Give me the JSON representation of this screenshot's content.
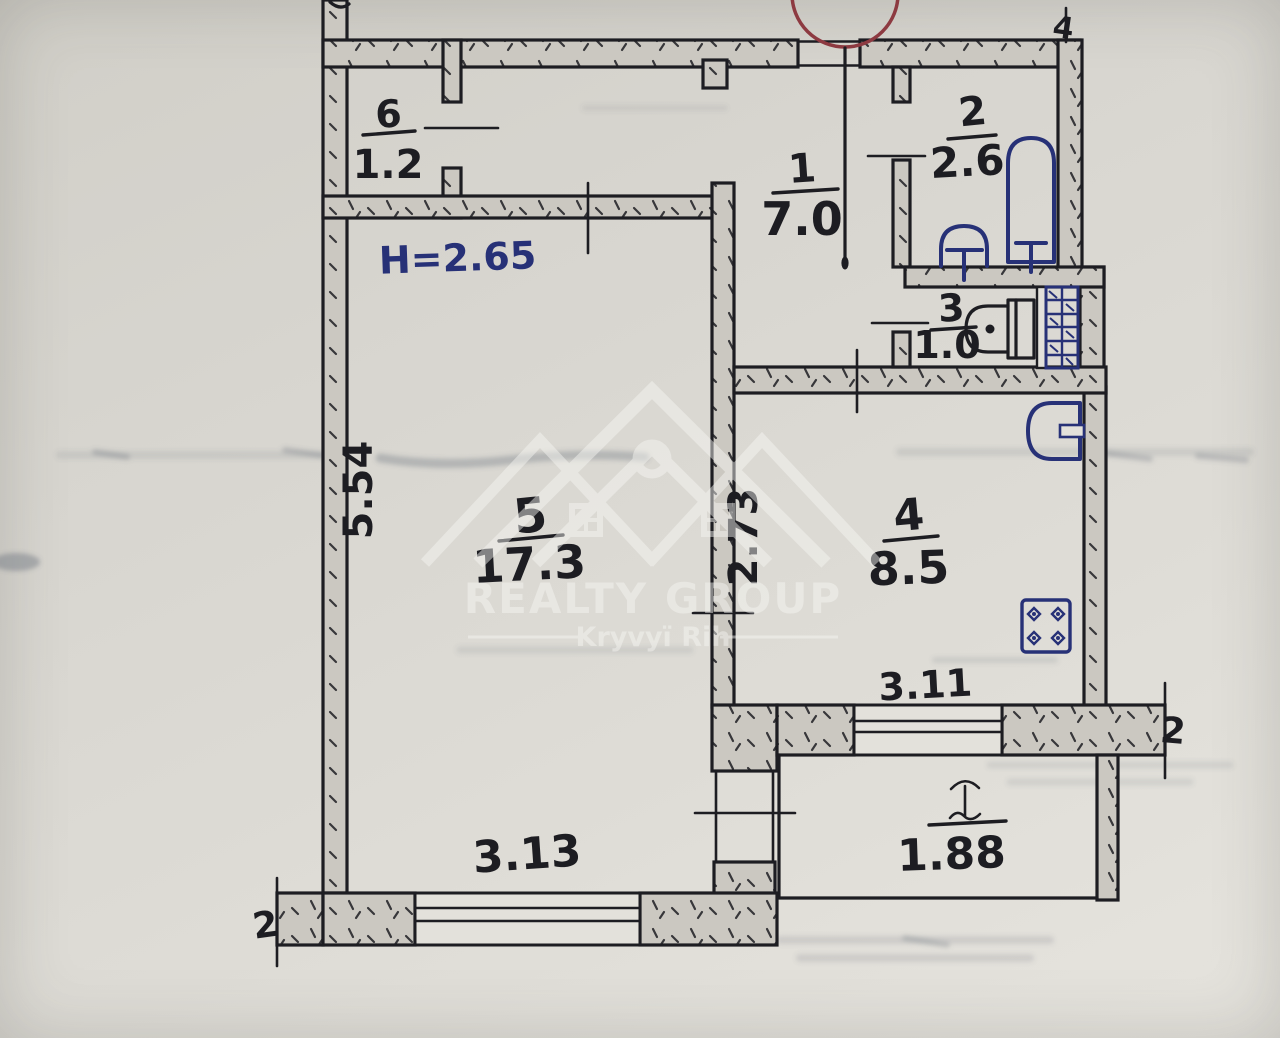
{
  "palette": {
    "paper": "#d8d6d0",
    "paper_light": "#e3e1db",
    "ink": "#1d1d22",
    "wall_fill": "#cbc8c1",
    "blue": "#273177",
    "red": "#8d3a41",
    "watermark": "#f6f6f3",
    "smudge": "#5d6470"
  },
  "plan_title": "Apartment floor plan",
  "rooms": {
    "vestibule": {
      "number": "6",
      "area": "1.2"
    },
    "hallway": {
      "number": "1",
      "area": "7.0"
    },
    "bathroom": {
      "number": "2",
      "area": "2.6"
    },
    "wc": {
      "number": "3",
      "area": "1.0"
    },
    "kitchen": {
      "number": "4",
      "area": "8.5"
    },
    "living_room": {
      "number": "5",
      "area": "17.3"
    }
  },
  "balcony": {
    "area": "1.88"
  },
  "annotations": {
    "ceiling_height": "Н=2.65"
  },
  "dimensions": {
    "living_room_depth": "5.54",
    "kitchen_depth": "2.73",
    "kitchen_window_width": "3.11",
    "living_room_window_width": "3.13"
  },
  "axis_marks": {
    "top_right": "4",
    "right": "2",
    "bottom_left": "2"
  },
  "watermark": {
    "title": "REALTY GROUP",
    "subtitle": "Kryvyï Rih"
  }
}
